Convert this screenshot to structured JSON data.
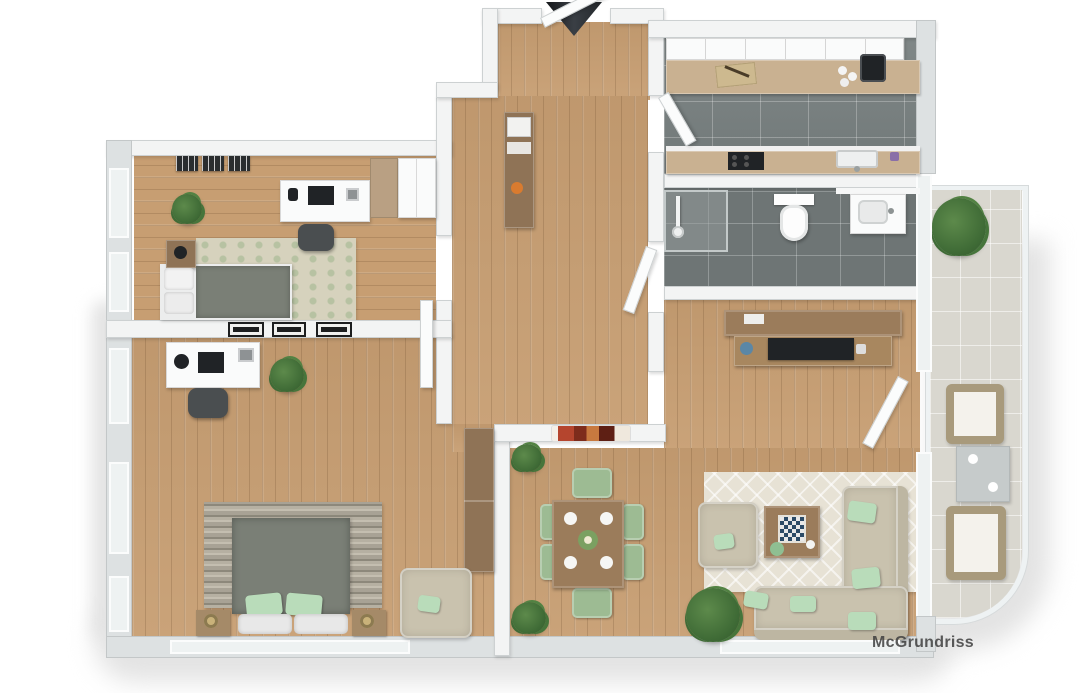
{
  "watermark": {
    "text": "McGrundriss"
  },
  "entry": {
    "arrow_icon": "entry-direction-arrow"
  },
  "palette": {
    "wood": "#c79e72",
    "counter_wood": "#c9b191",
    "tile": "#788080",
    "tile_bath": "#6e7575",
    "wall": "#f3f4f4",
    "wall_edge": "#cdd1d2",
    "outer_wall": "#dde1e2",
    "window_glass": "#eef2f2",
    "rug_cream": "#e7e2d5",
    "rug_stone": "#9f9a8c",
    "sofa_beige": "#c9c2ae",
    "mint": "#b9dcba",
    "chair_green": "#9dbb93",
    "furn_brown": "#8f7356",
    "table_brown": "#9b7c5b",
    "tv_black": "#202326",
    "bed_gray": "#7a7f76",
    "accent_blue": "#5b87a6",
    "accent_orange": "#d97b2f",
    "accent_purple": "#8a6fa8",
    "plant_green": "#3f6b36",
    "balcony_floor": "#d9d7cf",
    "shadow_gray": "#e3e3e3",
    "arrow_dark": "#24272b",
    "watermark_color": "#3f3f3f"
  }
}
